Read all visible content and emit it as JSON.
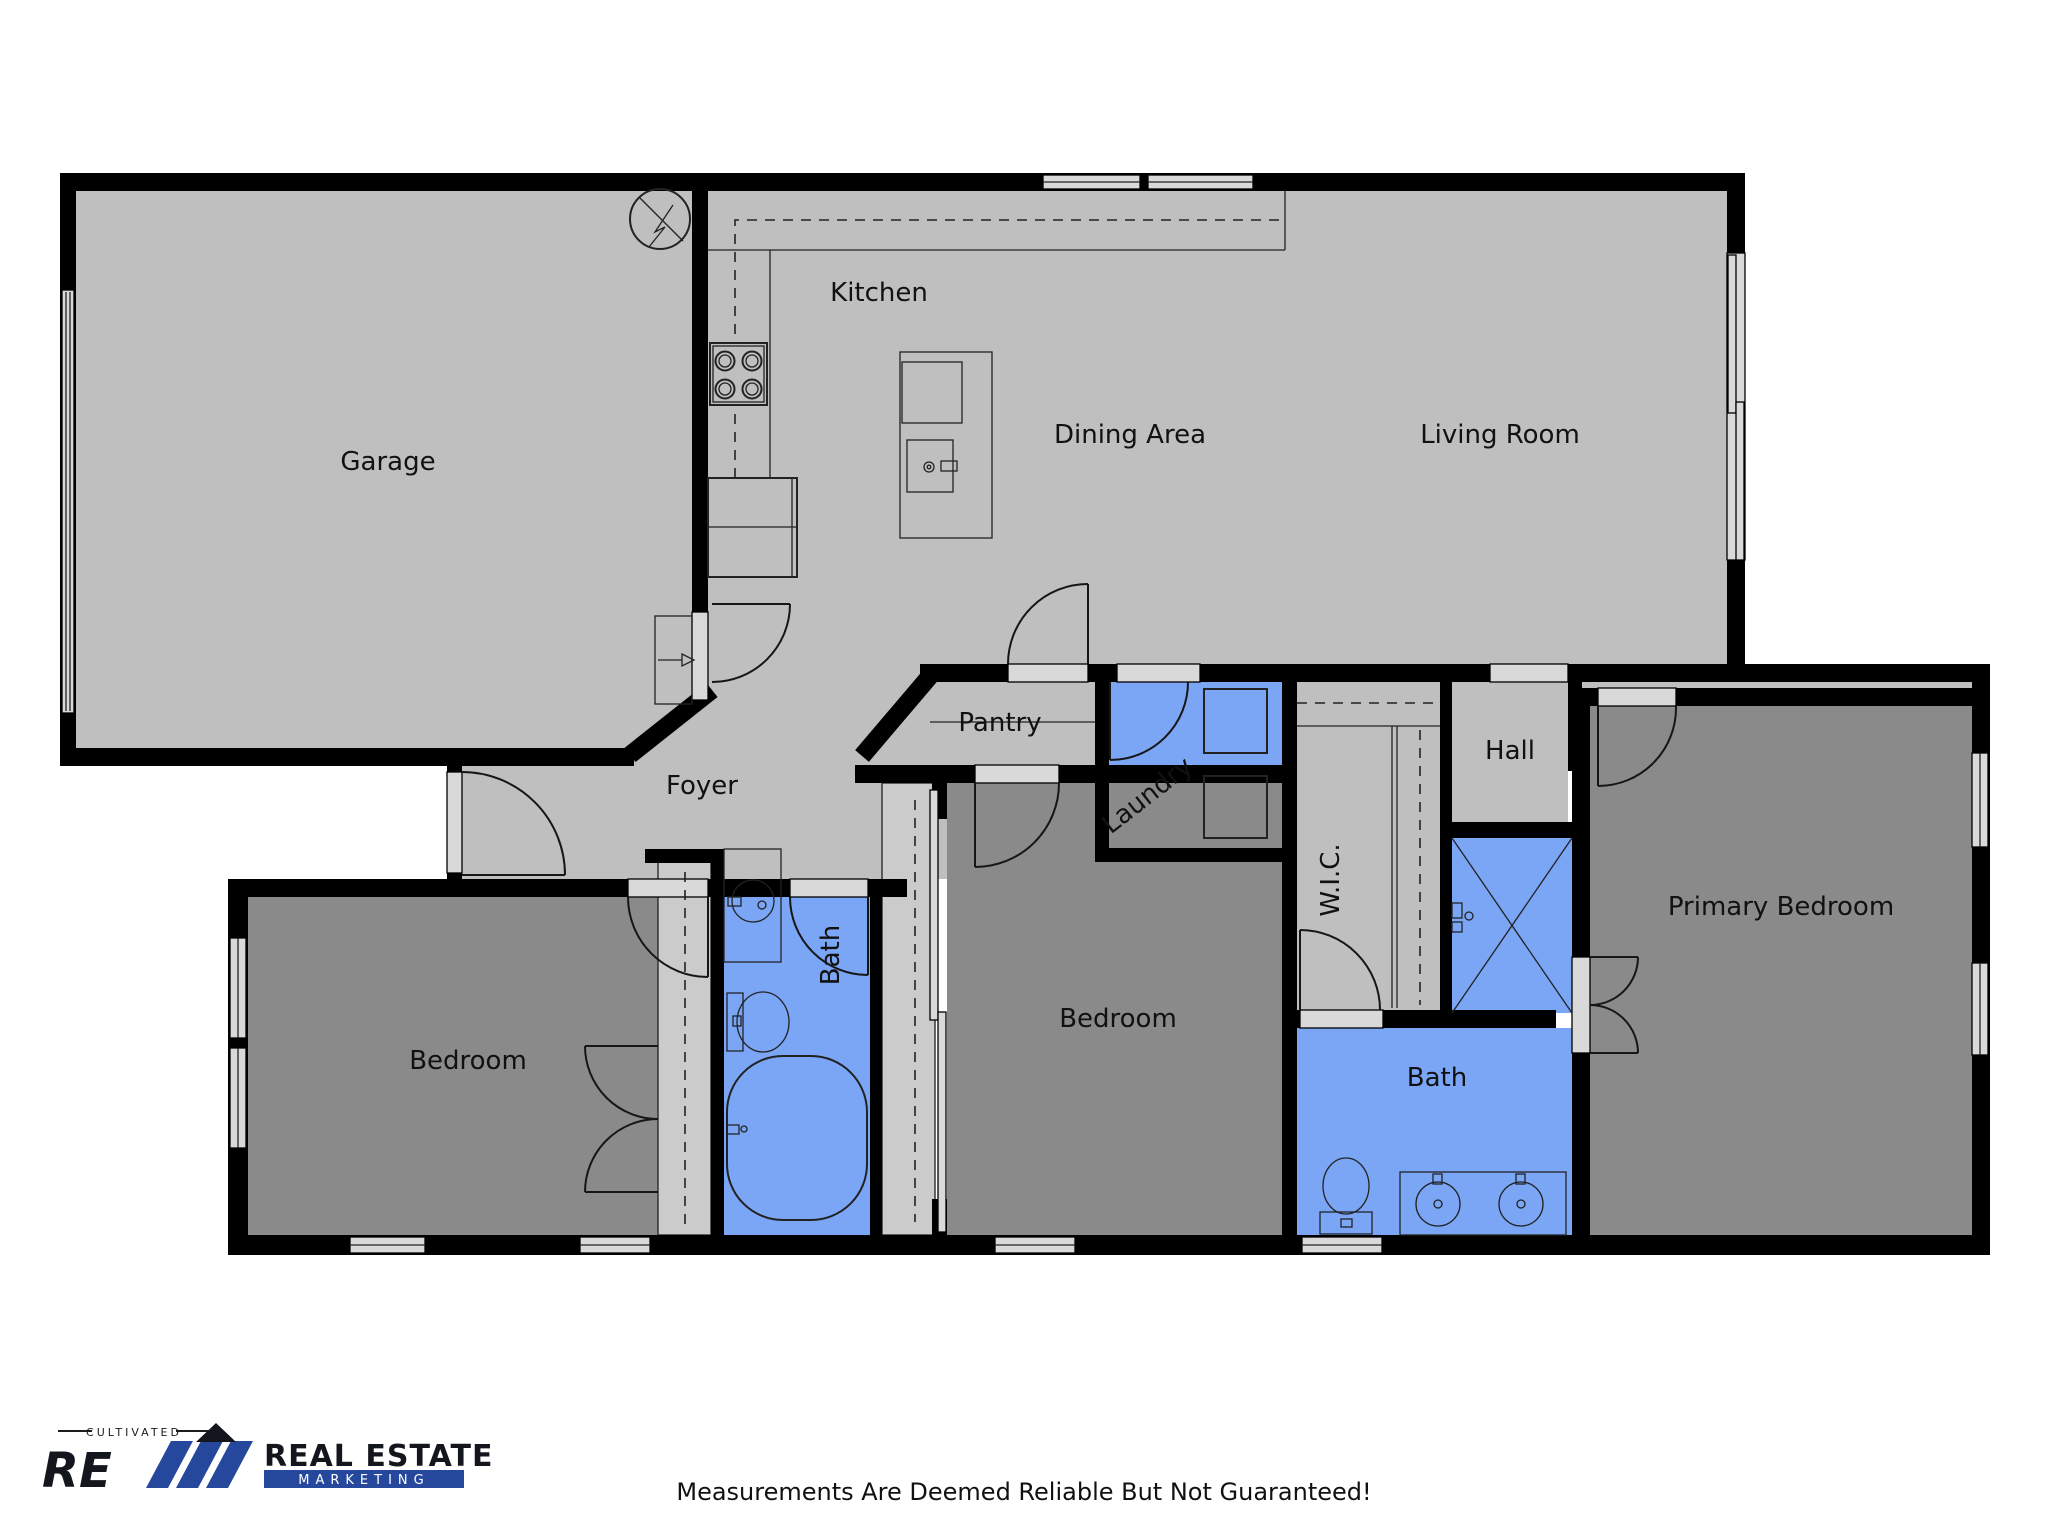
{
  "rooms": {
    "garage": "Garage",
    "kitchen": "Kitchen",
    "dining": "Dining Area",
    "living": "Living Room",
    "pantry": "Pantry",
    "foyer": "Foyer",
    "laundry": "Laundry",
    "hall": "Hall",
    "wic": "W.I.C.",
    "bath1": "Bath",
    "bedroom1": "Bedroom",
    "bedroom2": "Bedroom",
    "bath2": "Bath",
    "primary": "Primary Bedroom"
  },
  "footer": {
    "disclaimer": "Measurements Are Deemed Reliable But Not Guaranteed!"
  },
  "logo": {
    "tagline": "CULTIVATED",
    "monogram": "RE",
    "line1": "REAL ESTATE",
    "line2": "MARKETING"
  },
  "colors": {
    "floor": "#bfbfbf",
    "room_dark": "#8a8a8a",
    "wet_room": "#7ba5f5",
    "closet": "#cbcbcb",
    "wall": "#000000",
    "window": "#d9d9d9",
    "fixture_line": "#222222",
    "logo_navy": "#26489c",
    "label": "#111111"
  }
}
